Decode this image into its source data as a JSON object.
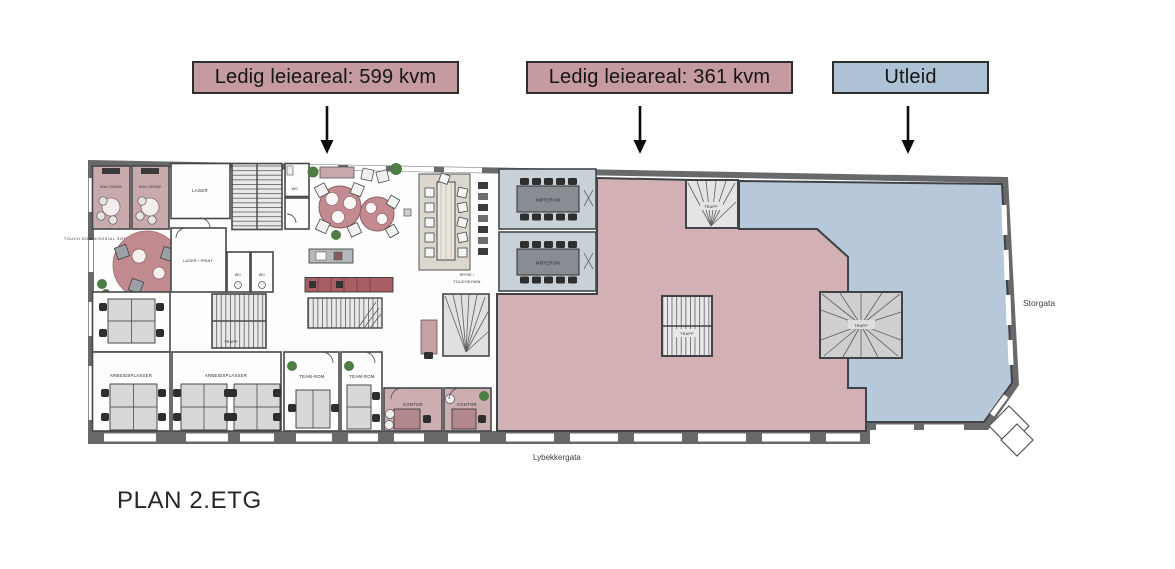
{
  "legend": {
    "items": [
      {
        "label": "Ledig leieareal: 599 kvm",
        "bg": "#c59ba0"
      },
      {
        "label": "Ledig leieareal: 361 kvm",
        "bg": "#c59ba0"
      },
      {
        "label": "Utleid",
        "bg": "#adc2d4"
      }
    ]
  },
  "colors": {
    "vacant_area": "#d3b0b4",
    "leased_area": "#b6c8d9",
    "wall": "#67696b",
    "floor": "#fdfdfd",
    "moterom_floor": "#c8d1d8",
    "multirom_floor": "#c8a9ac",
    "kontor_floor": "#ccadb0",
    "stair_floor": "#e6e6e6",
    "table_pink": "#c38b8f"
  },
  "plan": {
    "title": "PLAN 2.ETG",
    "street_right": "Storgata",
    "street_bottom": "Lybekkergata",
    "rooms": {
      "multirom": "MULTIROM",
      "lager": "LAGER",
      "touch_down_sone": "TOUCH DOWN/SOSIAL SONE",
      "lager_print": "LAGER / PRINT",
      "wc": "WC",
      "trapp": "TRAPP",
      "spise_line1": "SPISE /",
      "spise_line2": "TOUCHDOWN",
      "moterom": "MØTEROM",
      "arbeidsplasser": "ARBEIDSPLASSER",
      "teamrom": "TEAM-ROM",
      "kontor": "KONTOR"
    }
  }
}
